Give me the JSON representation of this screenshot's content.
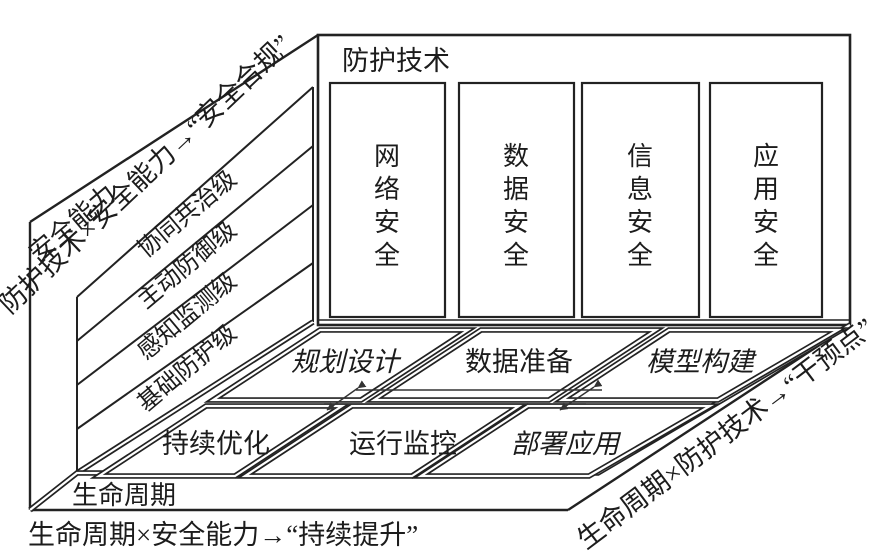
{
  "diagram": {
    "axes": {
      "protection_tech": "防护技术",
      "security_capability": "安全能力",
      "lifecycle": "生命周期"
    },
    "protection_columns": [
      "网络安全",
      "数据安全",
      "信息安全",
      "应用安全"
    ],
    "capability_levels": [
      "协同共治级",
      "主动防御级",
      "感知监测级",
      "基础防护级"
    ],
    "lifecycle_phases": {
      "back_row": [
        "规划设计",
        "数据准备",
        "模型构建"
      ],
      "front_row": [
        "持续优化",
        "运行监控",
        "部署应用"
      ]
    },
    "captions": {
      "top_left": "防护技术×安全能力→“安全合规”",
      "bottom_right": "生命周期×防护技术→“干预点”",
      "bottom_left": "生命周期×安全能力→“持续提升”"
    },
    "colors": {
      "stroke": "#222222",
      "background": "#ffffff"
    }
  }
}
